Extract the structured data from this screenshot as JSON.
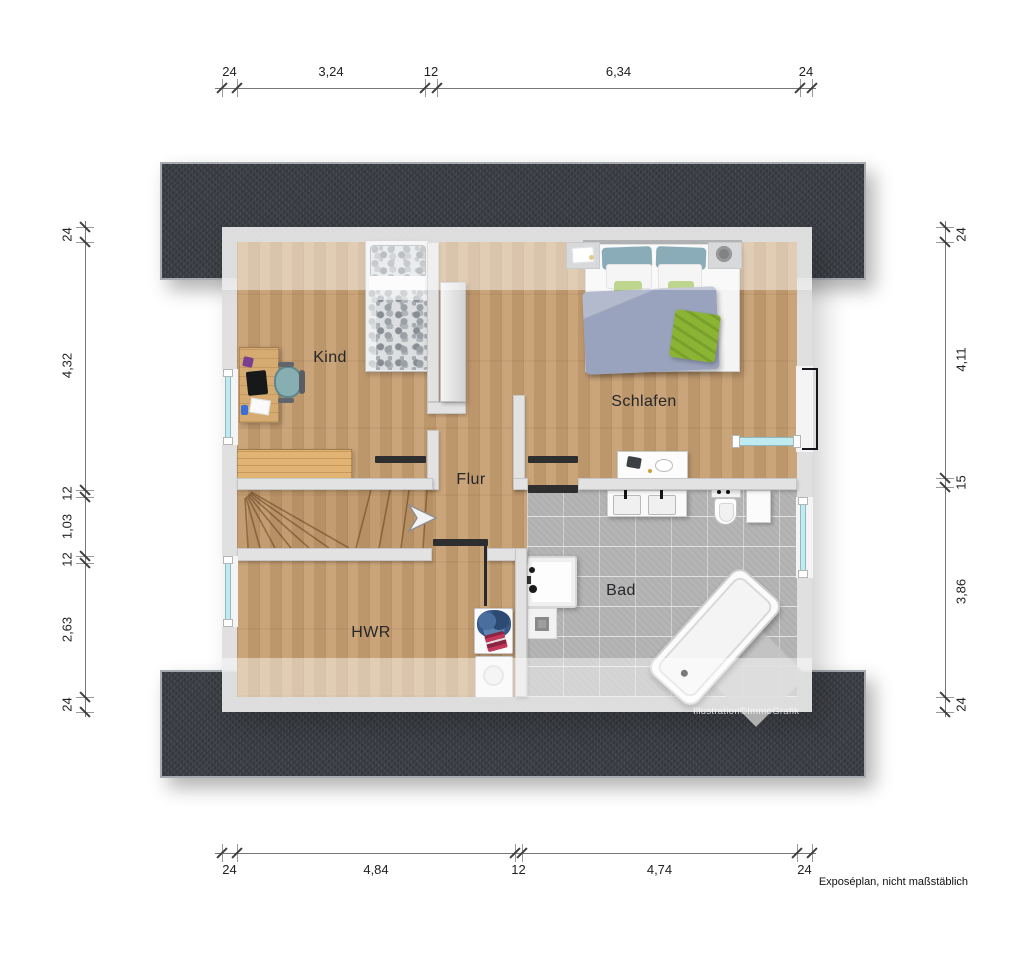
{
  "rooms": {
    "kind": {
      "label": "Kind"
    },
    "schlafen": {
      "label": "Schlafen"
    },
    "flur": {
      "label": "Flur"
    },
    "hwr": {
      "label": "HWR"
    },
    "bad": {
      "label": "Bad"
    }
  },
  "dimensions": {
    "top": [
      "24",
      "3,24",
      "12",
      "6,34",
      "24"
    ],
    "bottom": [
      "24",
      "4,84",
      "12",
      "4,74",
      "24"
    ],
    "left": [
      "24",
      "4,32",
      "12",
      "1,03",
      "12",
      "2,63",
      "24"
    ],
    "right": [
      "24",
      "4,11",
      "15",
      "3,86",
      "24"
    ]
  },
  "watermark": "Illustration©ImmoGrafik",
  "note": "Exposéplan, nicht maßstäblich",
  "icons": {
    "stair_arrow": "stair-direction-arrow-right"
  },
  "colors": {
    "roof_band": "#3a3d43",
    "wall": "#e2e2e2",
    "wood_floor": "#c79f72",
    "tile_floor": "#b5b5b5",
    "window_glass": "#bfeaf0",
    "pillow_teal": "#2f6b80",
    "accent_green": "#8cb434",
    "duvet_blue": "#9aa3bd"
  }
}
